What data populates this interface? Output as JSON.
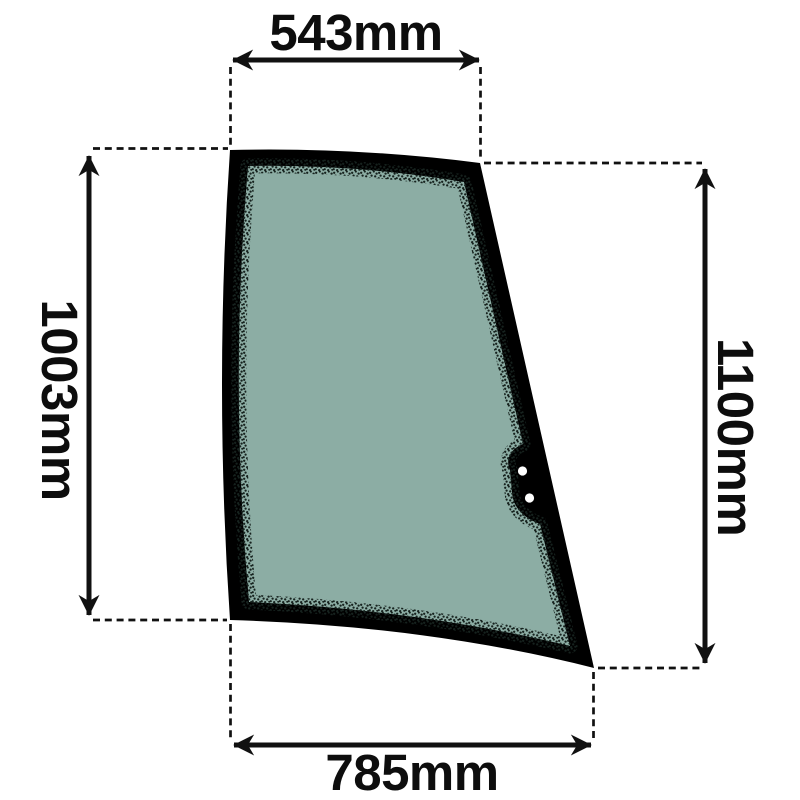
{
  "page": {
    "background": "#ffffff"
  },
  "diagram": {
    "part": {
      "kind": "door-glass-panel",
      "glass_color": "#8cada4",
      "seal_color": "#000000",
      "frit_dot_color": "#16221e",
      "bracket_hole_color": "#ffffff",
      "bracket_holes": 2
    },
    "dimensions": {
      "top": {
        "label": "543mm",
        "value": 543,
        "unit": "mm"
      },
      "left": {
        "label": "1003mm",
        "value": 1003,
        "unit": "mm"
      },
      "right": {
        "label": "1100mm",
        "value": 1100,
        "unit": "mm"
      },
      "bottom": {
        "label": "785mm",
        "value": 785,
        "unit": "mm"
      }
    },
    "line_color": "#111111"
  }
}
